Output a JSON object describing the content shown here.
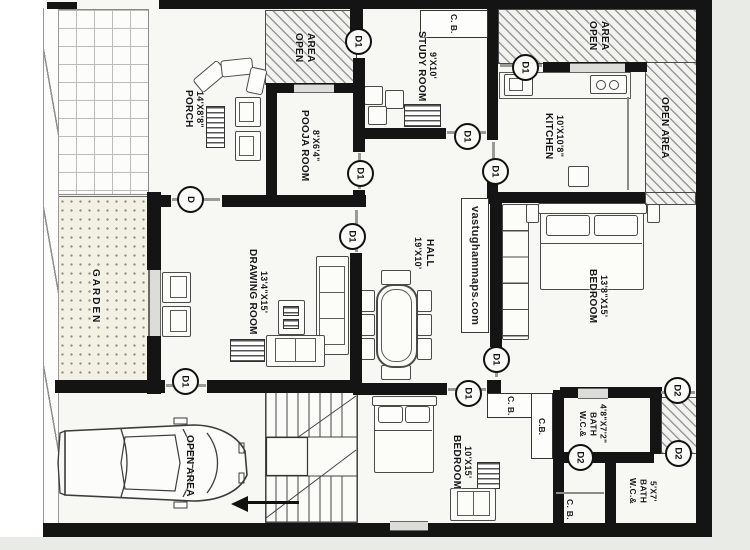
{
  "watermark": "vastughammaps.com",
  "labels": {
    "open": "OPEN",
    "area": "AREA",
    "open_area": "OPEN AREA",
    "cb_spaced": "C. B.",
    "cb": "C.B.",
    "door_main": "D",
    "door_1": "D1",
    "door_2": "D2"
  },
  "rooms": {
    "porch": {
      "name": "PORCH",
      "dim": "14'X8'8\""
    },
    "pooja": {
      "name": "POOJA ROOM",
      "dim": "8'X6'4\""
    },
    "study": {
      "name": "STUDY ROOM",
      "dim": "9'X10'"
    },
    "kitchen": {
      "name": "KITCHEN",
      "dim": "10'X10'8\""
    },
    "garden": {
      "name": "GARDEN"
    },
    "drawing": {
      "name": "DRAWING ROOM",
      "dim": "13'4\"X15'"
    },
    "hall": {
      "name": "HALL",
      "dim": "19'X10'"
    },
    "bedroom1": {
      "name": "BEDROOM",
      "dim": "13'8\"X15'"
    },
    "bedroom2": {
      "name": "BEDROOM",
      "dim": "10'X15'"
    },
    "bath1": {
      "name": "W.C.&",
      "name2": "BATH",
      "dim": "4'8\"X7'2\""
    },
    "bath2": {
      "name": "W.C.&",
      "name2": "BATH",
      "dim": "5'X7'"
    }
  },
  "colors": {
    "wall": "#141414",
    "floor": "#f7f7f4",
    "garden": "#f3f1e3",
    "page_margin": "#e9ebe6"
  }
}
